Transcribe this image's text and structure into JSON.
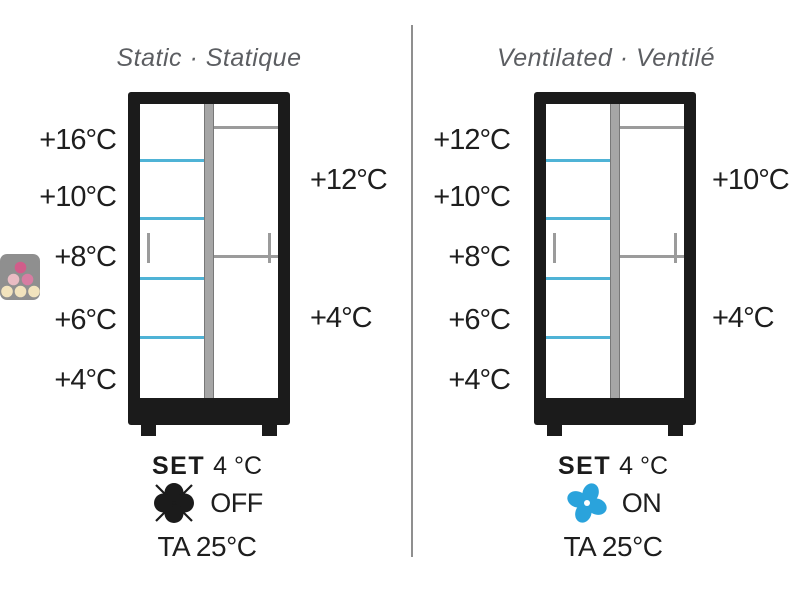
{
  "colors": {
    "frame_black": "#1b1b1b",
    "shelf_blue": "#4fb3d6",
    "shelf_grey": "#9b9b9b",
    "door_bar_grey": "#a6a6a6",
    "panel_divider_grey": "#8f8f8f",
    "title_grey": "#5c5e62",
    "fan_on_blue": "#2aa3dc",
    "logo_bg_grey": "#8f8f8f"
  },
  "logo": {
    "icon": "wine-bottles-logo"
  },
  "panels": [
    {
      "title": "Static · Statique",
      "left_temps": [
        "+16°C",
        "+10°C",
        "+8°C",
        "+6°C",
        "+4°C"
      ],
      "right_temps": [
        "+12°C",
        "+4°C"
      ],
      "set_label": "SET",
      "set_value": "4 °C",
      "fan_state": "OFF",
      "fan_icon": "fan-off-icon",
      "ambient_temp": "TA 25°C"
    },
    {
      "title": "Ventilated · Ventilé",
      "left_temps": [
        "+12°C",
        "+10°C",
        "+8°C",
        "+6°C",
        "+4°C"
      ],
      "right_temps": [
        "+10°C",
        "+4°C"
      ],
      "set_label": "SET",
      "set_value": "4 °C",
      "fan_state": "ON",
      "fan_icon": "fan-on-icon",
      "ambient_temp": "TA 25°C"
    }
  ]
}
